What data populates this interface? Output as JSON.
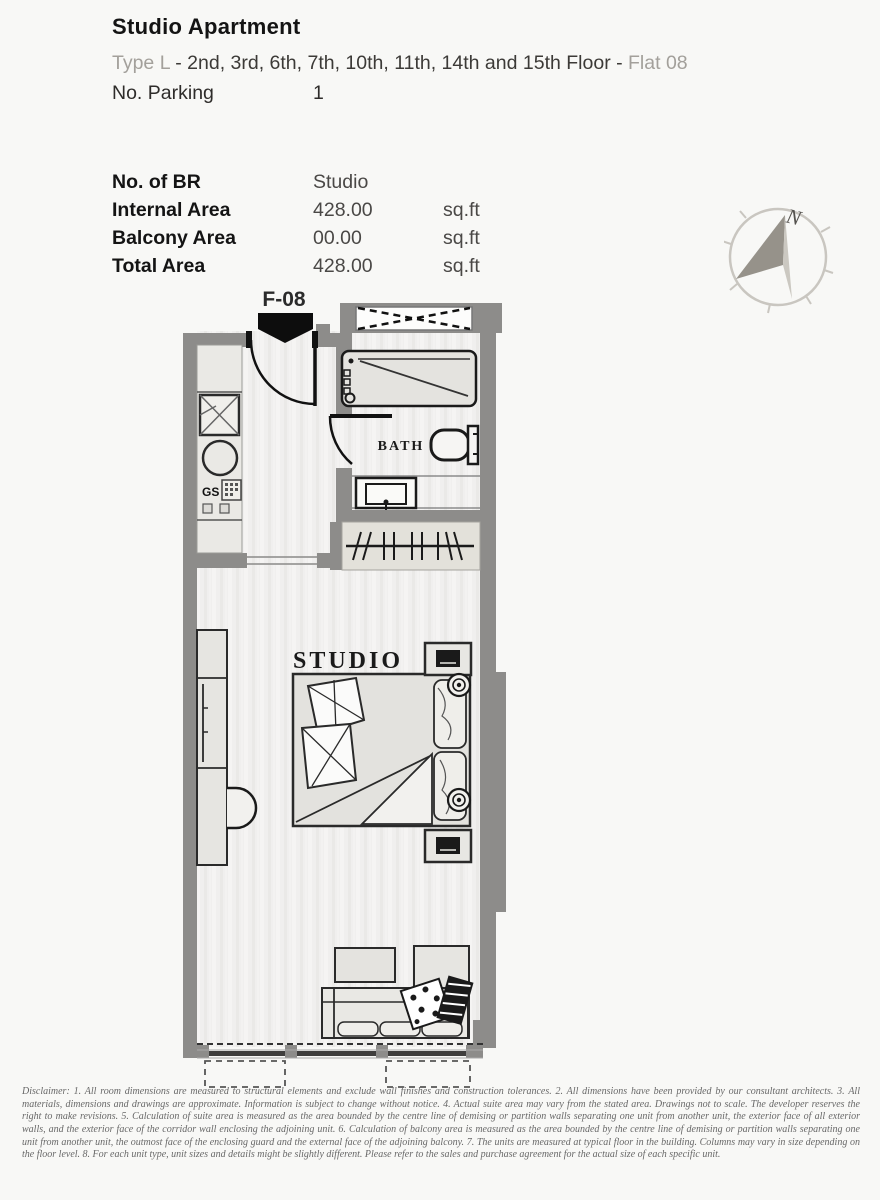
{
  "header": {
    "title": "Studio Apartment",
    "type_label": "Type L",
    "floors_text": " - 2nd, 3rd, 6th, 7th, 10th, 11th, 14th and 15th Floor - ",
    "flat_label": "Flat 08",
    "parking_label": "No. Parking",
    "parking_value": "1"
  },
  "area_table": {
    "rows": [
      {
        "label": "No. of BR",
        "value": "Studio",
        "unit": ""
      },
      {
        "label": "Internal Area",
        "value": "428.00",
        "unit": "sq.ft"
      },
      {
        "label": "Balcony Area",
        "value": "00.00",
        "unit": "sq.ft"
      },
      {
        "label": "Total Area",
        "value": "428.00",
        "unit": "sq.ft"
      }
    ]
  },
  "compass": {
    "north_label": "N"
  },
  "floor_plan": {
    "unit_label": "F-08",
    "studio_label": "STUDIO",
    "bath_label": "BATH",
    "stove_label": "GS"
  },
  "colors": {
    "wall": "#8d8c8a",
    "floor_light": "#f1f0ef",
    "furniture_fill": "#e3e2de",
    "outline": "#222222",
    "muted_text": "#a3a09b",
    "page_bg": "#f8f8f6"
  },
  "disclaimer": "Disclaimer: 1. All room dimensions are measured to structural elements and exclude wall finishes and construction tolerances. 2. All dimensions have been provided by our consultant architects. 3. All materials, dimensions and drawings are approximate. Information is subject to change without notice. 4. Actual suite area may vary from the stated area. Drawings not to scale. The developer reserves the right to make revisions. 5. Calculation of suite area is measured as the area bounded by the centre line of demising or partition walls separating one unit from another unit, the exterior face of all exterior walls, and the exterior face of the corridor wall enclosing the adjoining unit. 6. Calculation of balcony area is measured as the area bounded by the centre line of demising or partition walls separating one unit from another unit, the outmost face of the enclosing guard and the external face of the adjoining balcony. 7. The units are measured at typical floor in the building. Columns may vary in size depending on the floor level. 8. For each unit type, unit sizes and details might be slightly different. Please refer to the sales and purchase agreement for the actual size of each specific unit."
}
